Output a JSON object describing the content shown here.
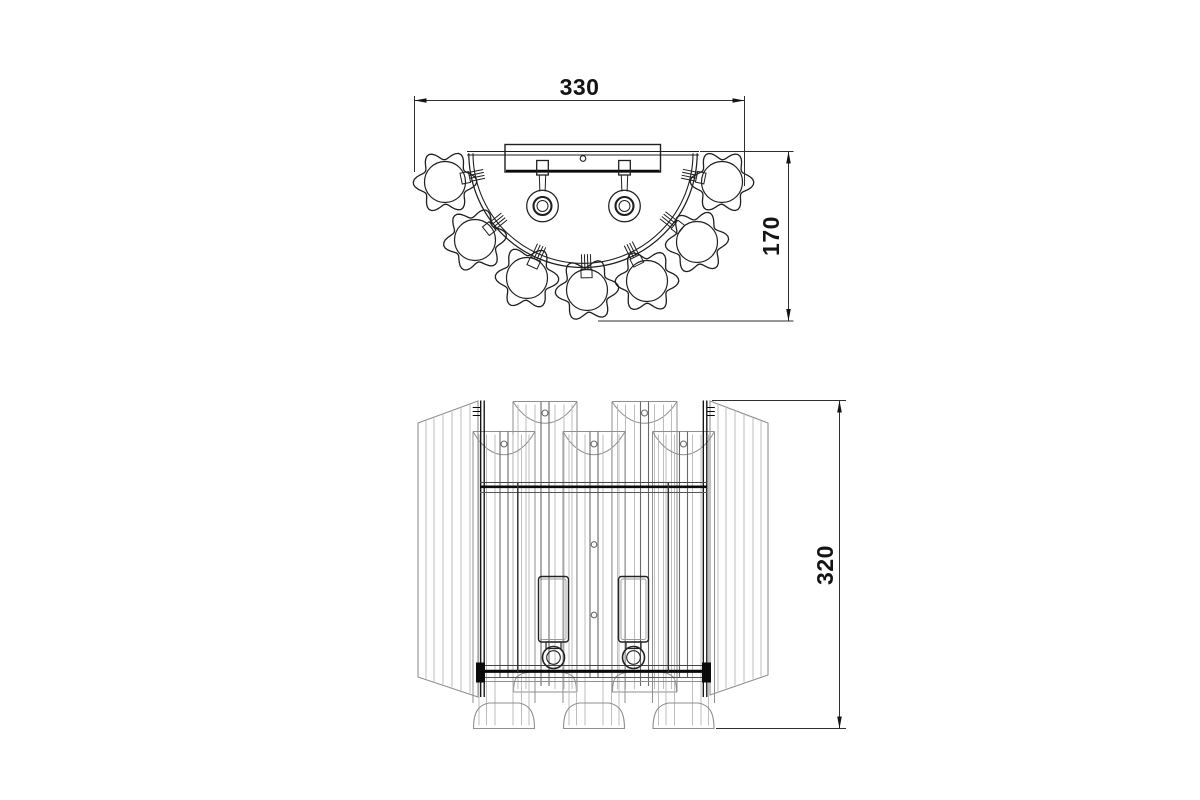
{
  "page": {
    "background": "#ffffff",
    "description": "Technical dimension drawing of a two-light crystal wall sconce: top view (above) and front elevation (below)"
  },
  "dimensions": {
    "width": {
      "label": "330",
      "units_px": 330
    },
    "depth": {
      "label": "170",
      "units_px": 170
    },
    "height": {
      "label": "320",
      "units_px": 320
    }
  },
  "style": {
    "line": "#1f1f1f",
    "frame": "#0a0a0a",
    "shade": "#8f8f8f",
    "stripe": "#b7b7b7",
    "strip": "#6a6a6a",
    "dim": "#2f2f2f",
    "text": "#141414",
    "background": "#ffffff"
  },
  "top_view": {
    "arc": {
      "cx": 583,
      "cy": 153.3,
      "r_outer": 114.2,
      "r_inner": 110
    },
    "plate": {
      "y1": 151.5,
      "y2": 155,
      "x1": 467,
      "x2": 699
    },
    "bar": {
      "x1": 505,
      "y1": 144.5,
      "x2": 660.5,
      "y2": 172,
      "bold_y": 170.8,
      "hole": {
        "cx": 583,
        "cy": 158.5,
        "r": 2.8
      }
    },
    "sockets": {
      "centers_x": [
        542.5,
        624.5
      ],
      "square": {
        "top": 160.5,
        "bottom": 175,
        "half_w": 5.8
      },
      "stem": {
        "bottom": 191.5,
        "half_w_top": 3.2,
        "half_w_bottom": 2.6
      },
      "rings": {
        "cy": 206,
        "radii": [
          15.8,
          9,
          5.5
        ]
      }
    },
    "flowers": {
      "petal_base_r": 27,
      "petal_amp": 4.8,
      "petal_count": 6,
      "inner_r": 20.5,
      "items": [
        {
          "cx": 445,
          "cy": 182,
          "rot": 10
        },
        {
          "cx": 475,
          "cy": 240,
          "rot": 55
        },
        {
          "cx": 527,
          "cy": 278,
          "rot": -15
        },
        {
          "cx": 587,
          "cy": 290,
          "rot": 28
        },
        {
          "cx": 647,
          "cy": 281,
          "rot": 5
        },
        {
          "cx": 697,
          "cy": 242,
          "rot": 40
        },
        {
          "cx": 722,
          "cy": 182,
          "rot": -8
        }
      ]
    },
    "clamps": {
      "tick_r1": 101,
      "tick_r2": 116,
      "tick_offsets": [
        -4.5,
        -1.5,
        1.5,
        4.5
      ],
      "rect_r1": 116,
      "rect_r2": 124.5,
      "rect_half_w": 5.5
    }
  },
  "front_view": {
    "outer_left": {
      "pts": [
        [
          418,
          423
        ],
        [
          478,
          401
        ],
        [
          478,
          697
        ],
        [
          418,
          677
        ]
      ],
      "stripes_x": [
        426,
        434,
        443,
        452,
        461,
        470
      ]
    },
    "outer_right": {
      "pts": [
        [
          710,
          401
        ],
        [
          768,
          423
        ],
        [
          768,
          675
        ],
        [
          710,
          695
        ]
      ],
      "stripes_x": [
        718,
        726,
        735,
        744,
        753,
        761
      ]
    },
    "back_shades": {
      "top": 401.5,
      "cup_dip": 29,
      "hole_y": 413,
      "side_bottom": 692,
      "strip_half_w": 4,
      "strip_bottom": 686,
      "dome_top": 672,
      "dome_bottom": 692,
      "stripe_offsets": [
        -27,
        -19,
        -10,
        10,
        19,
        27
      ],
      "items": [
        {
          "c": 545,
          "x1": 513,
          "x2": 577
        },
        {
          "c": 644.5,
          "x1": 612,
          "x2": 677
        }
      ]
    },
    "front_shades": {
      "top": 431.5,
      "cup_dip": 31,
      "hole_y": 444,
      "side_bottom": 703,
      "strip_half_w": 4,
      "strip_bottom": 677,
      "dome_top": 703,
      "dome_bottom": 728.5,
      "stripe_offsets": [
        -25,
        -17.5,
        -9,
        9,
        17.5,
        25
      ],
      "items": [
        {
          "c": 504,
          "x1": 473,
          "x2": 535
        },
        {
          "c": 594,
          "x1": 563,
          "x2": 625,
          "extra_holes_y": [
            544.5,
            615
          ]
        },
        {
          "c": 683.5,
          "x1": 652.5,
          "x2": 714.5
        }
      ]
    },
    "frame": {
      "posts": {
        "left_x": [
          480.7,
          484.2
        ],
        "right_x": [
          703.3,
          706.8
        ],
        "y1": 400.5,
        "y2": 697,
        "hatch_ys": [
          407.5,
          411.5,
          415.5
        ],
        "hatch_len": 8
      },
      "top_bar": {
        "x1": 480,
        "x2": 707,
        "thin1": 482.5,
        "thick": 486.8,
        "thin2": 492.5
      },
      "bottom_bar": {
        "x1": 480,
        "x2": 707,
        "thin1": 665.5,
        "thick": 671.3,
        "thin2": 677.5,
        "gray": 681.5,
        "caps_x": [
          476,
          702
        ],
        "cap_y": 662.5,
        "cap_w": 9,
        "cap_h": 20
      },
      "inner_x": [
        517.8,
        668.3
      ],
      "inner_y1": 483,
      "inner_y2": 672
    },
    "candles": {
      "centers_x": [
        553.5,
        633.5
      ],
      "tube": {
        "y1": 576.5,
        "y2": 642,
        "half_w": 15,
        "rx": 3,
        "inset": 2.5
      },
      "neck": {
        "y1": 642,
        "y2": 648.5,
        "half_w": 7.5
      },
      "rings": {
        "cy": 657.5,
        "r_outer": 11,
        "r_inner": 6.8
      }
    }
  },
  "dim_geometry": {
    "d330": {
      "line": {
        "y": 100.5,
        "x1": 414.5,
        "x2": 744.5
      },
      "ext": [
        {
          "x": 414.5,
          "y1": 96,
          "y2": 172
        },
        {
          "x": 744.5,
          "y1": 96,
          "y2": 186
        }
      ],
      "text": {
        "x": 579.5,
        "y": 95
      }
    },
    "d170": {
      "line": {
        "x": 788.5,
        "y1": 151.5,
        "y2": 321
      },
      "ext": [
        {
          "y": 151.5,
          "x1": 700,
          "x2": 793.5
        },
        {
          "y": 321,
          "x1": 598,
          "x2": 793.5
        }
      ],
      "text": {
        "x": 771,
        "y": 236
      }
    },
    "d320": {
      "line": {
        "x": 839.5,
        "y1": 400.5,
        "y2": 728.5
      },
      "ext": [
        {
          "y": 400.5,
          "x1": 712,
          "x2": 846
        },
        {
          "y": 728.5,
          "x1": 716,
          "x2": 846
        }
      ],
      "text": {
        "x": 825,
        "y": 565
      }
    }
  }
}
